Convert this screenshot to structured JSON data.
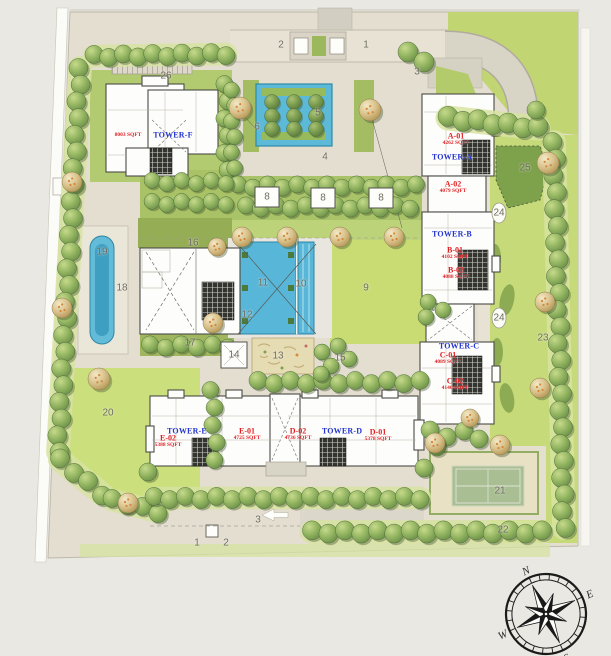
{
  "title": "residential-site-master-plan",
  "colors": {
    "accent_red": "#e01f22",
    "accent_blue": "#2334d0",
    "water": "#5cb9d7",
    "lawn": "#c8dc74",
    "tree_green": "#7d9f52",
    "paving": "#e5e0d1"
  },
  "tower_names": [
    {
      "text": "TOWER-F",
      "x": 173,
      "y": 135
    },
    {
      "text": "TOWER-A",
      "x": 452,
      "y": 157
    },
    {
      "text": "TOWER-B",
      "x": 452,
      "y": 234
    },
    {
      "text": "TOWER-C",
      "x": 459,
      "y": 346
    },
    {
      "text": "TOWER-E",
      "x": 187,
      "y": 431
    },
    {
      "text": "TOWER-D",
      "x": 342,
      "y": 431
    }
  ],
  "unit_labels": [
    {
      "code": "A-01",
      "sqft": "4262 SQFT",
      "x": 456,
      "y": 136
    },
    {
      "code": "A-02",
      "sqft": "4079 SQFT",
      "x": 453,
      "y": 184
    },
    {
      "code": "B-01",
      "sqft": "4102 SQFT",
      "x": 455,
      "y": 250
    },
    {
      "code": "B-02",
      "sqft": "4088 SQFT",
      "x": 456,
      "y": 270
    },
    {
      "code": "C-01",
      "sqft": "4089 SQFT",
      "x": 448,
      "y": 355
    },
    {
      "code": "C-02",
      "sqft": "4146 SQFT",
      "x": 455,
      "y": 381
    },
    {
      "code": "E-02",
      "sqft": "5388 SQFT",
      "x": 168,
      "y": 438
    },
    {
      "code": "E-01",
      "sqft": "4725 SQFT",
      "x": 247,
      "y": 431
    },
    {
      "code": "D-02",
      "sqft": "4736 SQFT",
      "x": 298,
      "y": 431
    },
    {
      "code": "D-01",
      "sqft": "5378 SQFT",
      "x": 378,
      "y": 432
    },
    {
      "code": "",
      "sqft": "8003 SQFT",
      "x": 128,
      "y": 135
    }
  ],
  "map_markers": [
    {
      "label": "1",
      "x": 366,
      "y": 45
    },
    {
      "label": "2",
      "x": 281,
      "y": 45
    },
    {
      "label": "3",
      "x": 417,
      "y": 72
    },
    {
      "label": "4",
      "x": 325,
      "y": 157
    },
    {
      "label": "5",
      "x": 318,
      "y": 113
    },
    {
      "label": "6",
      "x": 257,
      "y": 127
    },
    {
      "label": "8",
      "x": 267,
      "y": 197
    },
    {
      "label": "8",
      "x": 323,
      "y": 198
    },
    {
      "label": "8",
      "x": 381,
      "y": 198
    },
    {
      "label": "9",
      "x": 366,
      "y": 288
    },
    {
      "label": "10",
      "x": 301,
      "y": 284
    },
    {
      "label": "11",
      "x": 263,
      "y": 283
    },
    {
      "label": "12",
      "x": 247,
      "y": 315
    },
    {
      "label": "13",
      "x": 278,
      "y": 356
    },
    {
      "label": "14",
      "x": 234,
      "y": 355
    },
    {
      "label": "15",
      "x": 340,
      "y": 358
    },
    {
      "label": "16",
      "x": 193,
      "y": 243
    },
    {
      "label": "17",
      "x": 190,
      "y": 343
    },
    {
      "label": "18",
      "x": 122,
      "y": 288
    },
    {
      "label": "19",
      "x": 102,
      "y": 252
    },
    {
      "label": "20",
      "x": 108,
      "y": 413
    },
    {
      "label": "21",
      "x": 500,
      "y": 491
    },
    {
      "label": "22",
      "x": 503,
      "y": 530
    },
    {
      "label": "23",
      "x": 543,
      "y": 338
    },
    {
      "label": "24",
      "x": 499,
      "y": 213
    },
    {
      "label": "24",
      "x": 499,
      "y": 318
    },
    {
      "label": "25",
      "x": 525,
      "y": 168
    },
    {
      "label": "26",
      "x": 166,
      "y": 76
    },
    {
      "label": "1",
      "x": 197,
      "y": 543
    },
    {
      "label": "2",
      "x": 226,
      "y": 543
    },
    {
      "label": "3",
      "x": 258,
      "y": 520
    }
  ],
  "compass": {
    "north": "N",
    "east": "E",
    "south": "S",
    "west": "W"
  }
}
